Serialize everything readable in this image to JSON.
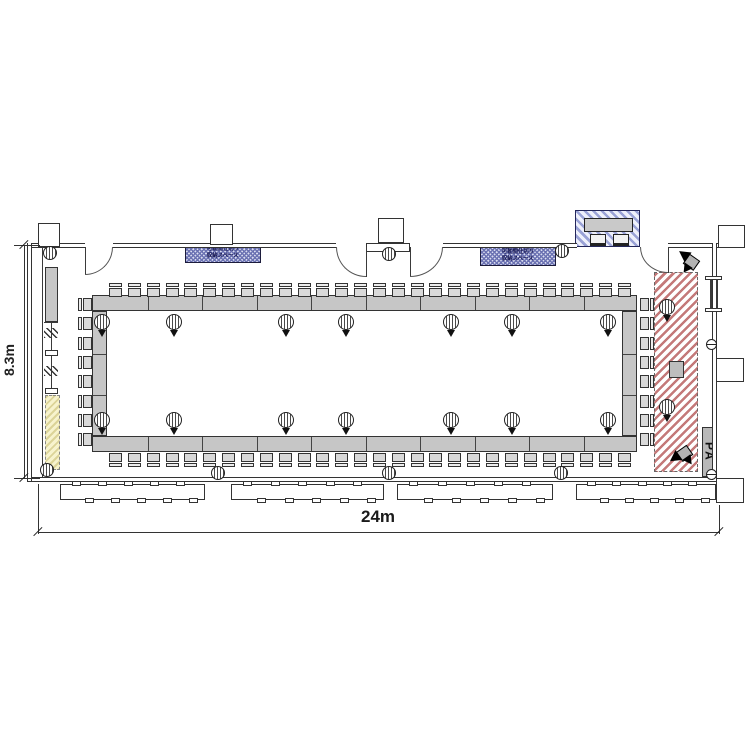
{
  "dimensions": {
    "height": "8.3m",
    "width": "24m"
  },
  "labels": {
    "pa": "PA",
    "partition_line1": "可動間仕切り",
    "partition_line2": "収納スペース"
  },
  "colors": {
    "wall": "#333333",
    "table_fill": "#c6c6c6",
    "blue_hatch": "#6b72b2",
    "red_hatch": "#ba6262",
    "yellow_fill": "#f7f3cd",
    "pa_fill": "#b8b8b8"
  },
  "geometry": {
    "walls_h": [
      [
        31,
        243,
        54
      ],
      [
        113,
        243,
        223
      ],
      [
        443,
        243,
        134
      ],
      [
        668,
        243,
        50
      ],
      [
        27,
        477,
        689
      ]
    ],
    "walls_v": [
      [
        27,
        243,
        238
      ],
      [
        712,
        243,
        237
      ]
    ],
    "pier": [
      [
        366,
        243,
        44,
        9
      ]
    ],
    "bumps": [
      [
        38,
        223,
        22,
        24
      ],
      [
        210,
        224,
        23,
        21
      ],
      [
        378,
        218,
        26,
        25
      ],
      [
        718,
        225,
        27,
        23
      ],
      [
        716,
        358,
        28,
        24
      ],
      [
        716,
        478,
        28,
        25
      ]
    ],
    "door_leafs": [
      [
        85,
        247,
        28
      ],
      [
        366,
        247,
        30
      ],
      [
        410,
        247,
        30
      ],
      [
        668,
        247,
        26
      ]
    ],
    "door_arcs": [
      [
        85,
        247,
        28,
        28,
        "br"
      ],
      [
        336,
        247,
        30,
        30,
        "bl"
      ],
      [
        410,
        247,
        33,
        30,
        "br"
      ],
      [
        640,
        247,
        28,
        26,
        "bl"
      ]
    ],
    "extra_lines": [
      [
        42,
        247,
        230,
        "v"
      ],
      [
        44,
        322,
        14,
        "h"
      ],
      [
        51,
        323,
        70,
        "v"
      ]
    ],
    "tables": [
      [
        92,
        295,
        545,
        16,
        "h",
        9
      ],
      [
        92,
        436,
        545,
        16,
        "h",
        9
      ],
      [
        92,
        311,
        15,
        125,
        "v",
        2
      ],
      [
        622,
        311,
        15,
        125,
        "v",
        2
      ]
    ],
    "chair_rows": [
      {
        "side": "top",
        "x": 109,
        "y": 283,
        "count": 28,
        "step": 18.85
      },
      {
        "side": "bottom",
        "x": 109,
        "y": 453,
        "count": 28,
        "step": 18.85
      },
      {
        "side": "left",
        "x": 78,
        "y": 298,
        "count": 8,
        "step": 19.3
      },
      {
        "side": "right",
        "x": 640,
        "y": 298,
        "count": 8,
        "step": 19.3
      }
    ],
    "floor_light_xs": [
      102,
      174,
      286,
      346,
      451,
      512,
      608
    ],
    "floor_light_rows": [
      322,
      420
    ],
    "floor_lights_extra": [
      [
        667,
        307
      ],
      [
        667,
        407
      ]
    ],
    "wall_lights": [
      [
        50,
        253
      ],
      [
        389,
        254
      ],
      [
        562,
        251
      ],
      [
        218,
        473
      ],
      [
        389,
        473
      ],
      [
        561,
        473
      ],
      [
        47,
        470
      ]
    ],
    "screws": [
      [
        711,
        344
      ],
      [
        711,
        474
      ]
    ],
    "radiators": {
      "y": 484,
      "h": 16,
      "segs": [
        [
          60,
          145
        ],
        [
          231,
          153
        ],
        [
          397,
          156
        ],
        [
          576,
          140
        ]
      ],
      "tick_fracs": [
        0.08,
        0.26,
        0.44,
        0.62,
        0.8
      ]
    },
    "partition_symbol": {
      "bars": [
        [
          45,
          350
        ],
        [
          45,
          388
        ]
      ],
      "hatches": [
        [
          44,
          328
        ],
        [
          44,
          366
        ]
      ],
      "cabinet": [
        45,
        267,
        13,
        55
      ]
    },
    "ladder": {
      "bars": [
        [
          705,
          276
        ],
        [
          705,
          308
        ]
      ],
      "rails": [
        [
          710,
          279,
          30
        ],
        [
          716,
          279,
          30
        ]
      ]
    },
    "speakers": [
      [
        676,
        246,
        35
      ],
      [
        668,
        440,
        -35
      ]
    ],
    "dim_v": {
      "x": 24,
      "y1": 245,
      "y2": 478,
      "ext": [
        [
          14,
          245,
          26
        ],
        [
          14,
          478,
          26
        ]
      ]
    },
    "dim_h": {
      "y": 532,
      "x1": 38,
      "x2": 719,
      "ext": [
        [
          38,
          484,
          50
        ],
        [
          719,
          505,
          29
        ]
      ]
    }
  }
}
